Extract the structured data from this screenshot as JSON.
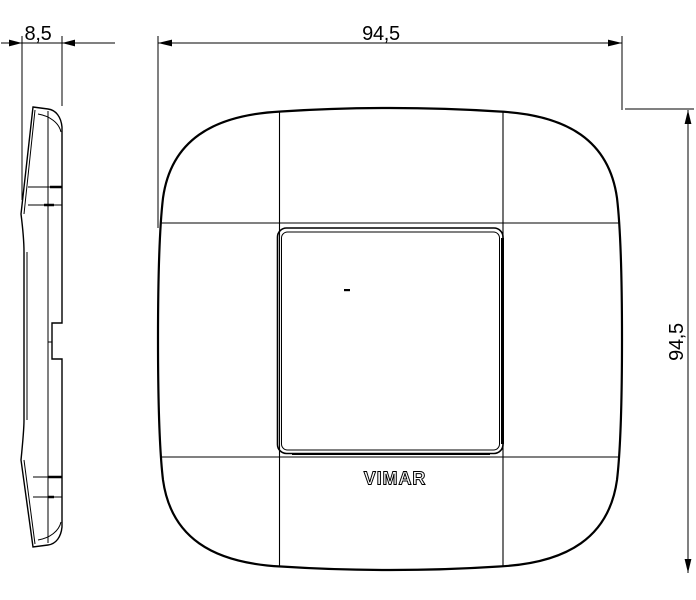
{
  "drawing": {
    "type_label": "technical-dimension-drawing",
    "brand_label": "VIMAR",
    "dim_depth": "8,5",
    "dim_width": "94,5",
    "dim_height": "94,5",
    "line_color": "#000000",
    "background_color": "#ffffff"
  }
}
